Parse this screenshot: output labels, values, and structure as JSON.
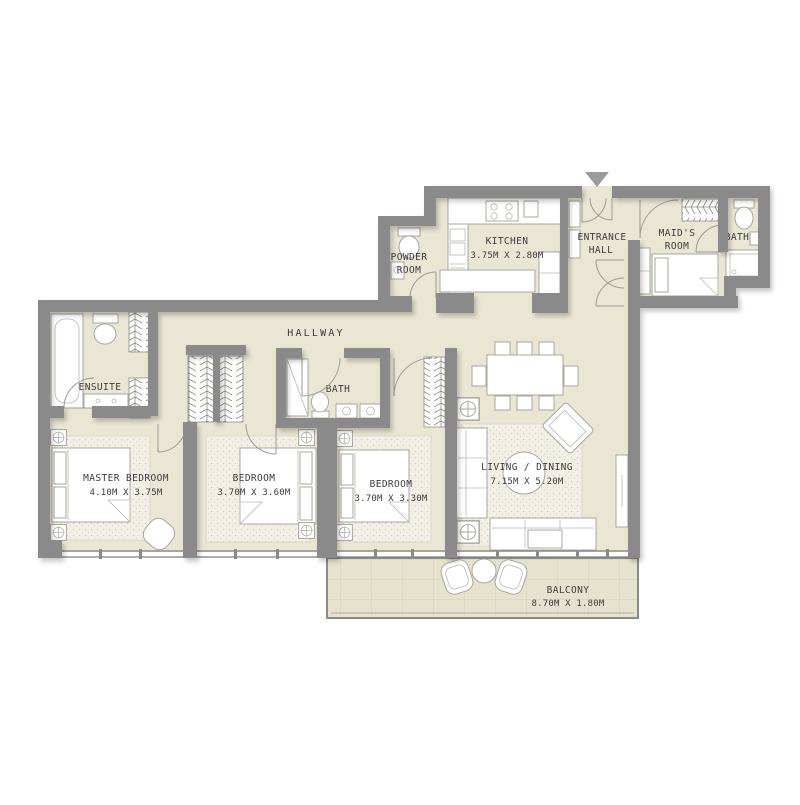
{
  "title": "Apartment Floor Plan",
  "colors": {
    "floor_beige": "#eae6d4",
    "wall_gray": "#8a8a8a",
    "furniture_white": "#ffffff",
    "line_gray": "#9b9b94",
    "text": "#3b3b3b"
  },
  "rooms": {
    "master_bedroom": {
      "name": "MASTER BEDROOM",
      "dims": "4.10M X 3.75M"
    },
    "bedroom_2": {
      "name": "BEDROOM",
      "dims": "3.70M X 3.60M"
    },
    "bedroom_3": {
      "name": "BEDROOM",
      "dims": "3.70M X 3.30M"
    },
    "living_dining": {
      "name": "LIVING / DINING",
      "dims": "7.15M X 5.20M"
    },
    "kitchen": {
      "name": "KITCHEN",
      "dims": "3.75M X 2.80M"
    },
    "entrance_hall": {
      "line1": "ENTRANCE",
      "line2": "HALL"
    },
    "maids_room": {
      "line1": "MAID'S",
      "line2": "ROOM"
    },
    "maids_bath": {
      "name": "BATH"
    },
    "powder_room": {
      "line1": "POWDER",
      "line2": "ROOM"
    },
    "hallway": {
      "name": "HALLWAY"
    },
    "ensuite": {
      "name": "ENSUITE"
    },
    "bath": {
      "name": "BATH"
    },
    "balcony": {
      "name": "BALCONY",
      "dims": "8.70M X 1.80M"
    }
  },
  "markers": {
    "entrance_arrow": "entrance-direction-arrow"
  }
}
